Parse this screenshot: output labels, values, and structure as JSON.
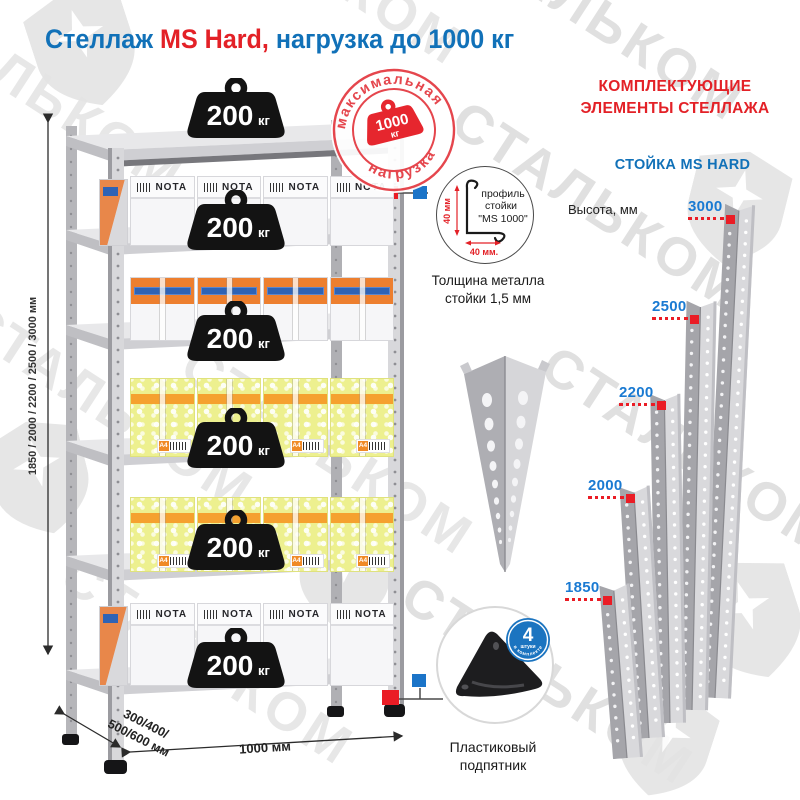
{
  "title": {
    "part1": "Стеллаж ",
    "part2": "MS Hard,",
    "part3": " нагрузка до 1000 кг"
  },
  "watermark": {
    "text": "СТАЛЬКОМ"
  },
  "stamp": {
    "arc_top": "максимальная",
    "arc_bottom": "нагрузка",
    "value": "1000",
    "unit": "кг"
  },
  "rack": {
    "weight_value": "200",
    "weight_unit": "кг",
    "box_brand": "NOTA",
    "box_label_a4": "A4",
    "dim_height": "1850 / 2000 / 2200 / 2500 / 3000 мм",
    "dim_depth_line1": "300/400/",
    "dim_depth_line2": "500/600 мм",
    "dim_width": "1000 мм"
  },
  "profile": {
    "line1": "профиль",
    "line2": "стойки",
    "line3": "\"MS 1000\"",
    "dim_vertical": "40 мм",
    "dim_horizontal": "40 мм.",
    "caption_line1": "Толщина металла",
    "caption_line2": "стойки 1,5 мм"
  },
  "foot": {
    "badge_number": "4",
    "badge_word": "штуки",
    "badge_arc": "в комплекте",
    "caption_line1": "Пластиковый",
    "caption_line2": "подпятник"
  },
  "components": {
    "header_line1": "КОМПЛЕКТУЮЩИЕ",
    "header_line2": "ЭЛЕМЕНТЫ СТЕЛЛАЖА",
    "subheader": "СТОЙКА MS HARD",
    "height_label": "Высота, мм",
    "posts": [
      {
        "height": "3000"
      },
      {
        "height": "2500"
      },
      {
        "height": "2200"
      },
      {
        "height": "2000"
      },
      {
        "height": "1850"
      }
    ]
  },
  "colors": {
    "blue": "#1171b8",
    "red": "#e32127",
    "label_blue": "#1a7ad2",
    "marker_blue": "#1b74c8",
    "marker_red": "#ea1c25",
    "metal_light": "#d9d9dc",
    "metal_dark": "#a8a8ad"
  }
}
